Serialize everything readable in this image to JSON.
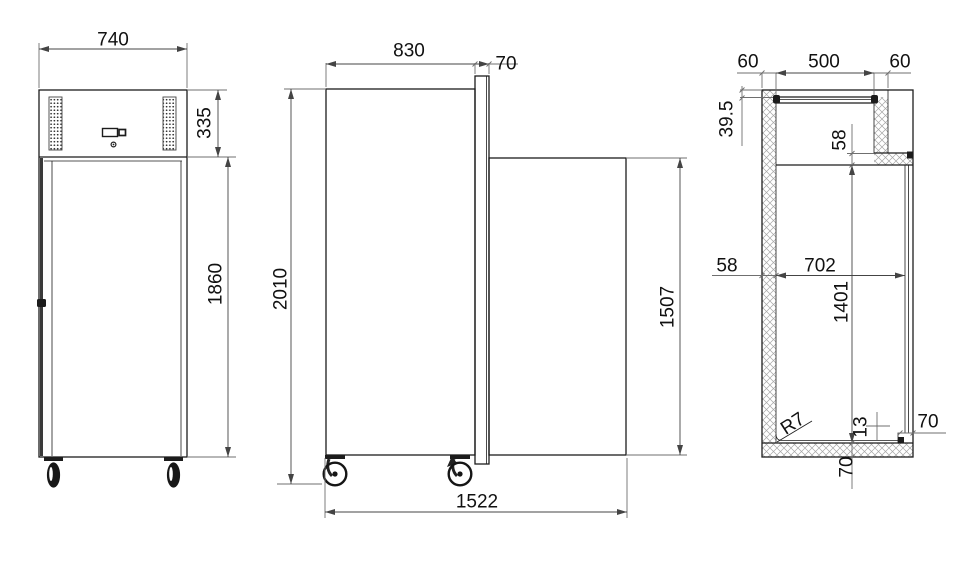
{
  "views": {
    "front": {
      "labels": {
        "overall_width": "740",
        "machine_compartment_height": "335",
        "body_height": "1860"
      }
    },
    "side": {
      "labels": {
        "overall_depth": "830",
        "door_thickness": "70",
        "overall_height": "2010",
        "door_height": "1507",
        "depth_door_open": "1522"
      }
    },
    "section": {
      "labels": {
        "left_wall_thickness": "60",
        "top_opening_width": "500",
        "right_wall_thickness": "60",
        "top_panel_inset": "39.5",
        "top_duct_height": "58",
        "rear_wall_thickness": "58",
        "interior_depth": "702",
        "interior_height": "1401",
        "inner_corner_radius": "R7",
        "floor_panel_thickness": "13",
        "front_wall_thickness": "70",
        "bottom_insulation_thickness": "70"
      }
    }
  },
  "colors": {
    "background": "#ffffff",
    "object_line": "#1c1c1c",
    "dimension_line": "#6f6f6f",
    "text": "#111111"
  }
}
